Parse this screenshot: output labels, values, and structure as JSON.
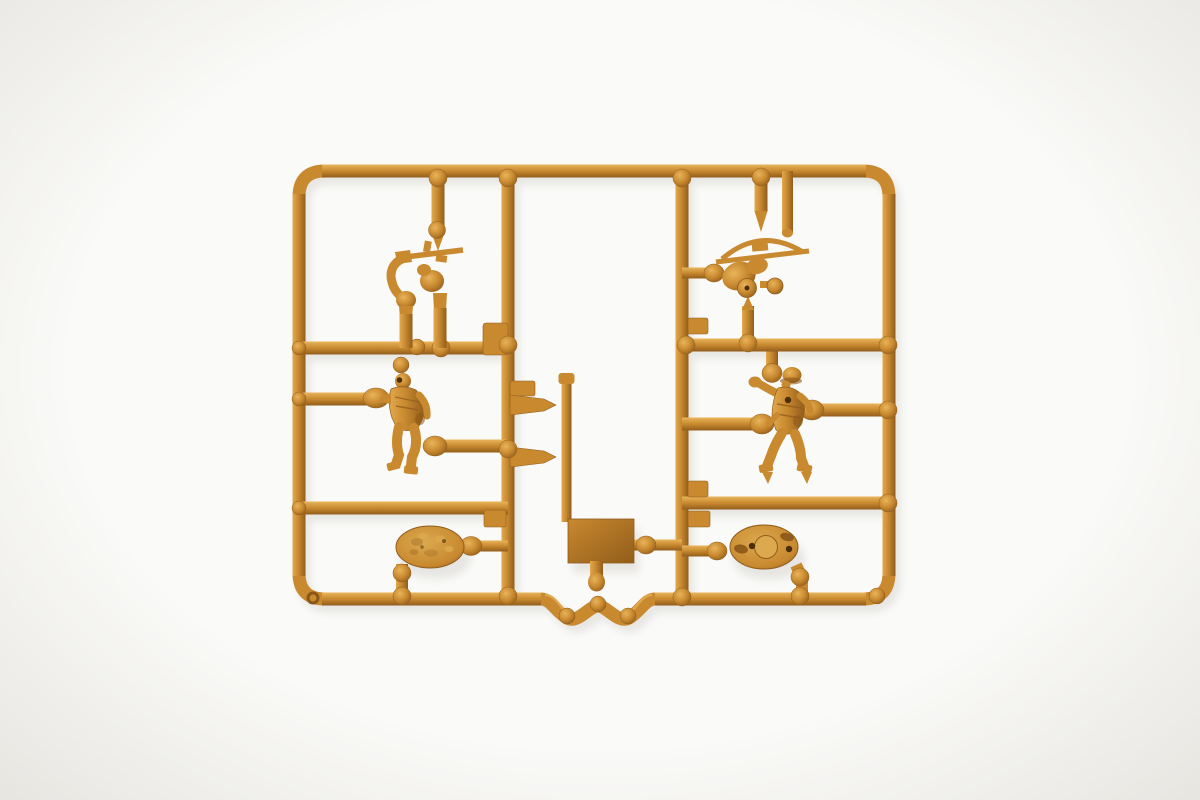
{
  "meta": {
    "description": "Overhead product photo of an ochre-tan injection-molded plastic model-kit sprue (runner frame) holding small-scale toy soldier parts, on a plain white background",
    "alt": "Tan plastic model sprue with two soldier figures, two weapon/arm parts, two oval bases and a molding plate attached to a rectangular runner frame"
  },
  "colors": {
    "background": "#fafaf8",
    "plastic_base": "#c8892f",
    "plastic_highlight": "#e9b45a",
    "plastic_highlight_soft": "#e2a94f",
    "plastic_shadow": "#925d1b",
    "plastic_deep_shadow": "#8a5718",
    "base_top_light": "#dca94f",
    "hole_dark": "#4a2e08"
  },
  "scene": {
    "object": "plastic model kit sprue",
    "material": "injection-molded polystyrene, ochre/tan color",
    "frame_shape": "rounded rectangle with W-shaped injection-gate dip at bottom center",
    "counts": {
      "soldier_figures": 2,
      "weapon_or_arm_parts": 2,
      "oval_bases": 2,
      "molding_plates": 1
    }
  },
  "parts": [
    {
      "name": "rifle-arms-part",
      "kind": "figure part",
      "label": "pair of arms holding a rifle",
      "location": "upper left"
    },
    {
      "name": "standing-soldier-left",
      "kind": "figure",
      "label": "standing soldier with arm extended",
      "location": "middle left"
    },
    {
      "name": "weapon-part",
      "kind": "figure part",
      "label": "gunner/weapon cluster with curved guard and barrel",
      "location": "upper right"
    },
    {
      "name": "walking-soldier-right",
      "kind": "figure",
      "label": "helmeted soldier with raised arm",
      "location": "middle right"
    },
    {
      "name": "oval-base-left",
      "kind": "figure base",
      "label": "textured oval base, top side up",
      "location": "lower left"
    },
    {
      "name": "oval-base-right",
      "kind": "figure base",
      "label": "oval base underside with peg holes and slots",
      "location": "lower right"
    },
    {
      "name": "center-plate",
      "kind": "molding block",
      "label": "rectangular plate with sprue peg below",
      "location": "bottom center"
    }
  ]
}
